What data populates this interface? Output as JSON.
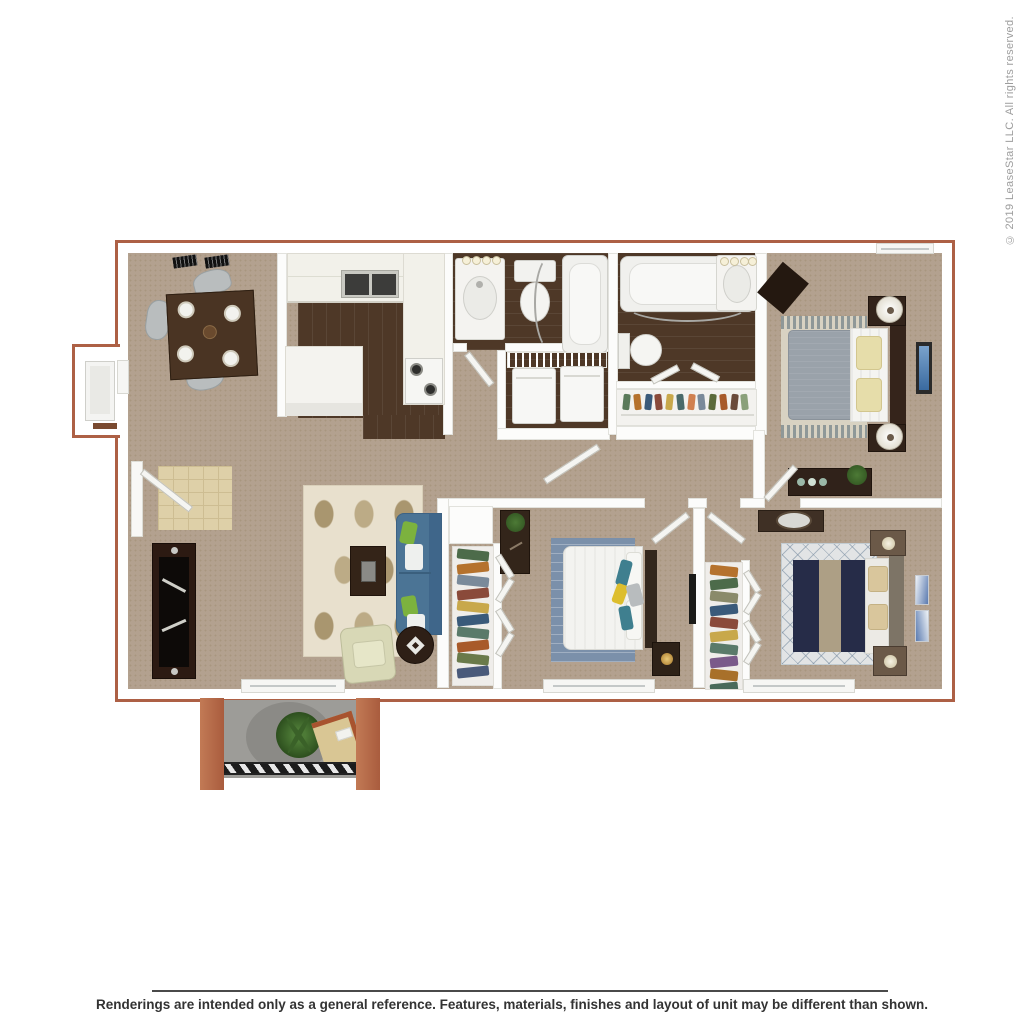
{
  "page": {
    "copyright": "© 2019 LeaseStar LLC. All rights reserved.",
    "disclaimer": "Renderings are intended only as a general reference. Features, materials, finishes and layout of unit may be different than shown."
  },
  "floorplan": {
    "description": "3D top-down rendering of a 3-bedroom, 2-bath apartment with patio",
    "palette": {
      "brick_outline": "#ad6045",
      "wall": "#fcfcfb",
      "carpet": "#b3a18f",
      "wood_floor": "#4e3827",
      "entry_tile": "#ded0a8",
      "patio_concrete": "#9d9c98",
      "sofa_blue": "#4b7495",
      "bedroom2_rug": "#7b90aa",
      "bedroom3_bed_navy": "#262c48",
      "master_blanket_gray": "#9aa2aa",
      "accent_green": "#7cb23e",
      "accent_yellow": "#ddbe2e"
    },
    "rooms": [
      {
        "name": "dining-area",
        "furniture": [
          "dining-table",
          "four-chairs",
          "place-settings",
          "ceiling-vents"
        ]
      },
      {
        "name": "kitchen",
        "furniture": [
          "double-sink",
          "stove",
          "counters",
          "peninsula-counter"
        ]
      },
      {
        "name": "hall-bathroom",
        "furniture": [
          "vanity-sink",
          "toilet",
          "bathtub",
          "curtain-rod"
        ]
      },
      {
        "name": "laundry-closet",
        "furniture": [
          "washer",
          "dryer",
          "wire-shelf"
        ]
      },
      {
        "name": "master-bathroom",
        "furniture": [
          "bathtub",
          "toilet",
          "vanity-sink"
        ]
      },
      {
        "name": "hall-closet",
        "furniture": [
          "hanging-clothes",
          "shelf"
        ]
      },
      {
        "name": "master-bedroom",
        "furniture": [
          "bed",
          "nightstands",
          "lamps",
          "dresser",
          "wall-art",
          "area-rug"
        ]
      },
      {
        "name": "living-room",
        "furniture": [
          "sofa",
          "armchair",
          "coffee-table",
          "side-table",
          "tv-console",
          "patterned-rug",
          "entry-door",
          "tile-entry"
        ]
      },
      {
        "name": "bedroom-2",
        "furniture": [
          "bed",
          "desk",
          "nightstand",
          "blue-rug",
          "closet",
          "wall-tv"
        ]
      },
      {
        "name": "bedroom-3",
        "furniture": [
          "bed",
          "nightstands",
          "dresser-with-mirror",
          "diamond-rug",
          "closet",
          "wall-art"
        ]
      },
      {
        "name": "patio",
        "furniture": [
          "plant",
          "patio-chair",
          "round-rug",
          "railing"
        ]
      },
      {
        "name": "storage-closet-exterior",
        "furniture": [
          "door"
        ]
      }
    ],
    "closets": {
      "hall": [
        "#5a7a5a",
        "#b5722d",
        "#3a5a7a",
        "#8a4a3a",
        "#c8a84b",
        "#4a6a6a",
        "#d08050",
        "#7a8a9a",
        "#5a6a3a",
        "#a85a2a",
        "#6a4a3a",
        "#8aa07a"
      ],
      "bed2": [
        "#4d6b4a",
        "#b5722d",
        "#7a8a9a",
        "#8a4a3a",
        "#c8a84b",
        "#3a5a7a",
        "#5a7a6a",
        "#a85a2a",
        "#6a7a4a",
        "#4a5a7a"
      ],
      "bed3": [
        "#b5722d",
        "#4d6b4a",
        "#8a8a6a",
        "#3a5a7a",
        "#8a4a3a",
        "#c8a84b",
        "#5a7a6a",
        "#7a5a8a",
        "#a8702a",
        "#4a6a5a"
      ]
    }
  }
}
